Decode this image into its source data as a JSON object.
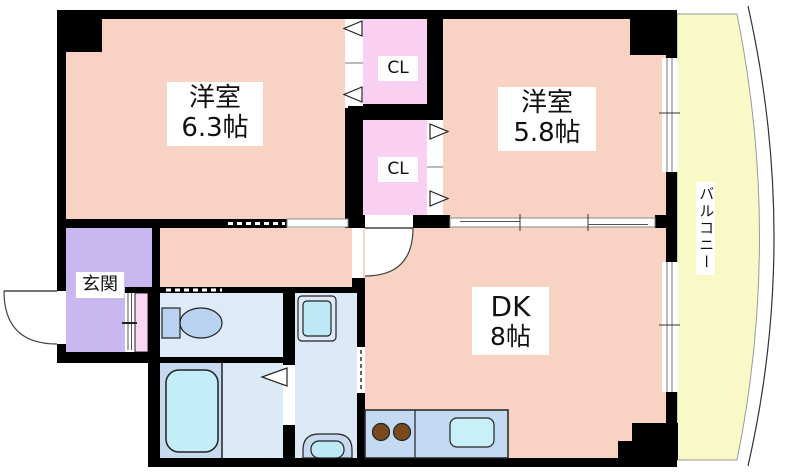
{
  "plan": {
    "rooms": {
      "western1": {
        "label": "洋室",
        "size": "6.3帖"
      },
      "western2": {
        "label": "洋室",
        "size": "5.8帖"
      },
      "dk": {
        "label": "DK",
        "size": "8帖"
      },
      "entrance": {
        "label": "玄関"
      },
      "balcony": {
        "label": "バルコニー"
      },
      "closet_upper": {
        "label": "CL"
      },
      "closet_lower": {
        "label": "CL"
      }
    },
    "colors": {
      "wall": "#000000",
      "room": "#F8D3C3",
      "closet": "#F9CFF2",
      "closet_small": "#FBD7F3",
      "entrance": "#C9B7EF",
      "balcony": "#F9F9C8",
      "toilet_room": "#DEEAF8",
      "bath_room": "#C6D9EE",
      "wash_room": "#DCE9F7",
      "bathtub": "#C2EDF9",
      "fixture_blue": "#B9D2F0",
      "fixture_cyan": "#BFE8F7",
      "counter": "#C3DAF2",
      "sink": "#C9EFF8",
      "burner": "#7A4A1F"
    }
  }
}
